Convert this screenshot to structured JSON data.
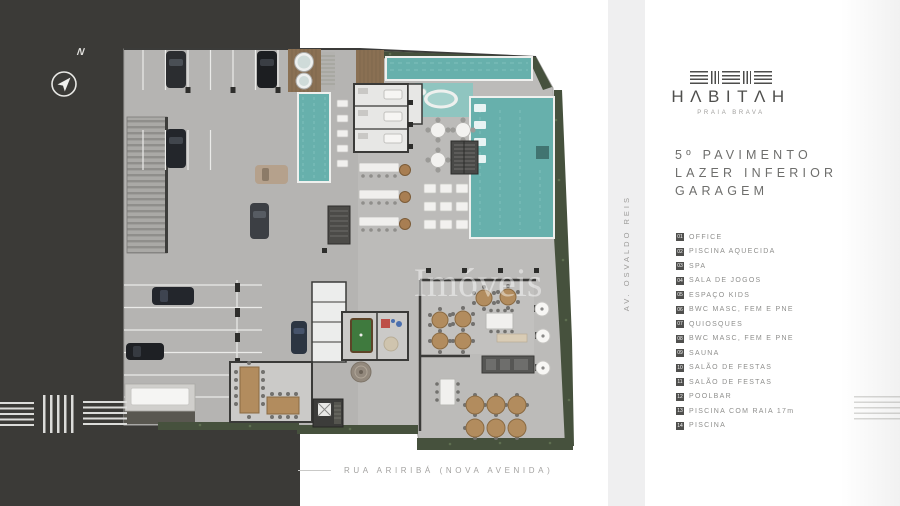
{
  "brand": {
    "name": "HΛBITΛH",
    "tagline": "PRAIA BRAVA"
  },
  "title": {
    "line1": "5º PAVIMENTO",
    "line2": "LAZER INFERIOR",
    "line3": "GARAGEM"
  },
  "legend": {
    "items": [
      {
        "num": "01",
        "label": "OFFICE"
      },
      {
        "num": "02",
        "label": "PISCINA AQUECIDA"
      },
      {
        "num": "03",
        "label": "SPA"
      },
      {
        "num": "04",
        "label": "SALA DE JOGOS"
      },
      {
        "num": "05",
        "label": "ESPAÇO KIDS"
      },
      {
        "num": "06",
        "label": "BWC MASC, FEM E PNE"
      },
      {
        "num": "07",
        "label": "QUIOSQUES"
      },
      {
        "num": "08",
        "label": "BWC MASC, FEM E PNE"
      },
      {
        "num": "09",
        "label": "SAUNA"
      },
      {
        "num": "10",
        "label": "SALÃO DE FESTAS"
      },
      {
        "num": "11",
        "label": "SALÃO DE FESTAS"
      },
      {
        "num": "12",
        "label": "POOLBAR"
      },
      {
        "num": "13",
        "label": "PISCINA COM RAIA 17m"
      },
      {
        "num": "14",
        "label": "PISCINA"
      }
    ]
  },
  "plan": {
    "watermark": "Imóveis",
    "street_bottom": "RUA ARIRIBÁ (NOVA AVENIDA)",
    "street_side": "AV. OSVALDO REIS",
    "compass_label": "N"
  },
  "colors": {
    "background_dark": "#3b3a37",
    "pool_water": "#67b0ac",
    "wet_deck": "#8fc5c0",
    "hedge_green": "#46513d",
    "concrete": "#bcbbb9",
    "legend_badge": "#4f4f4d",
    "text_gray": "#8f8f8d"
  }
}
